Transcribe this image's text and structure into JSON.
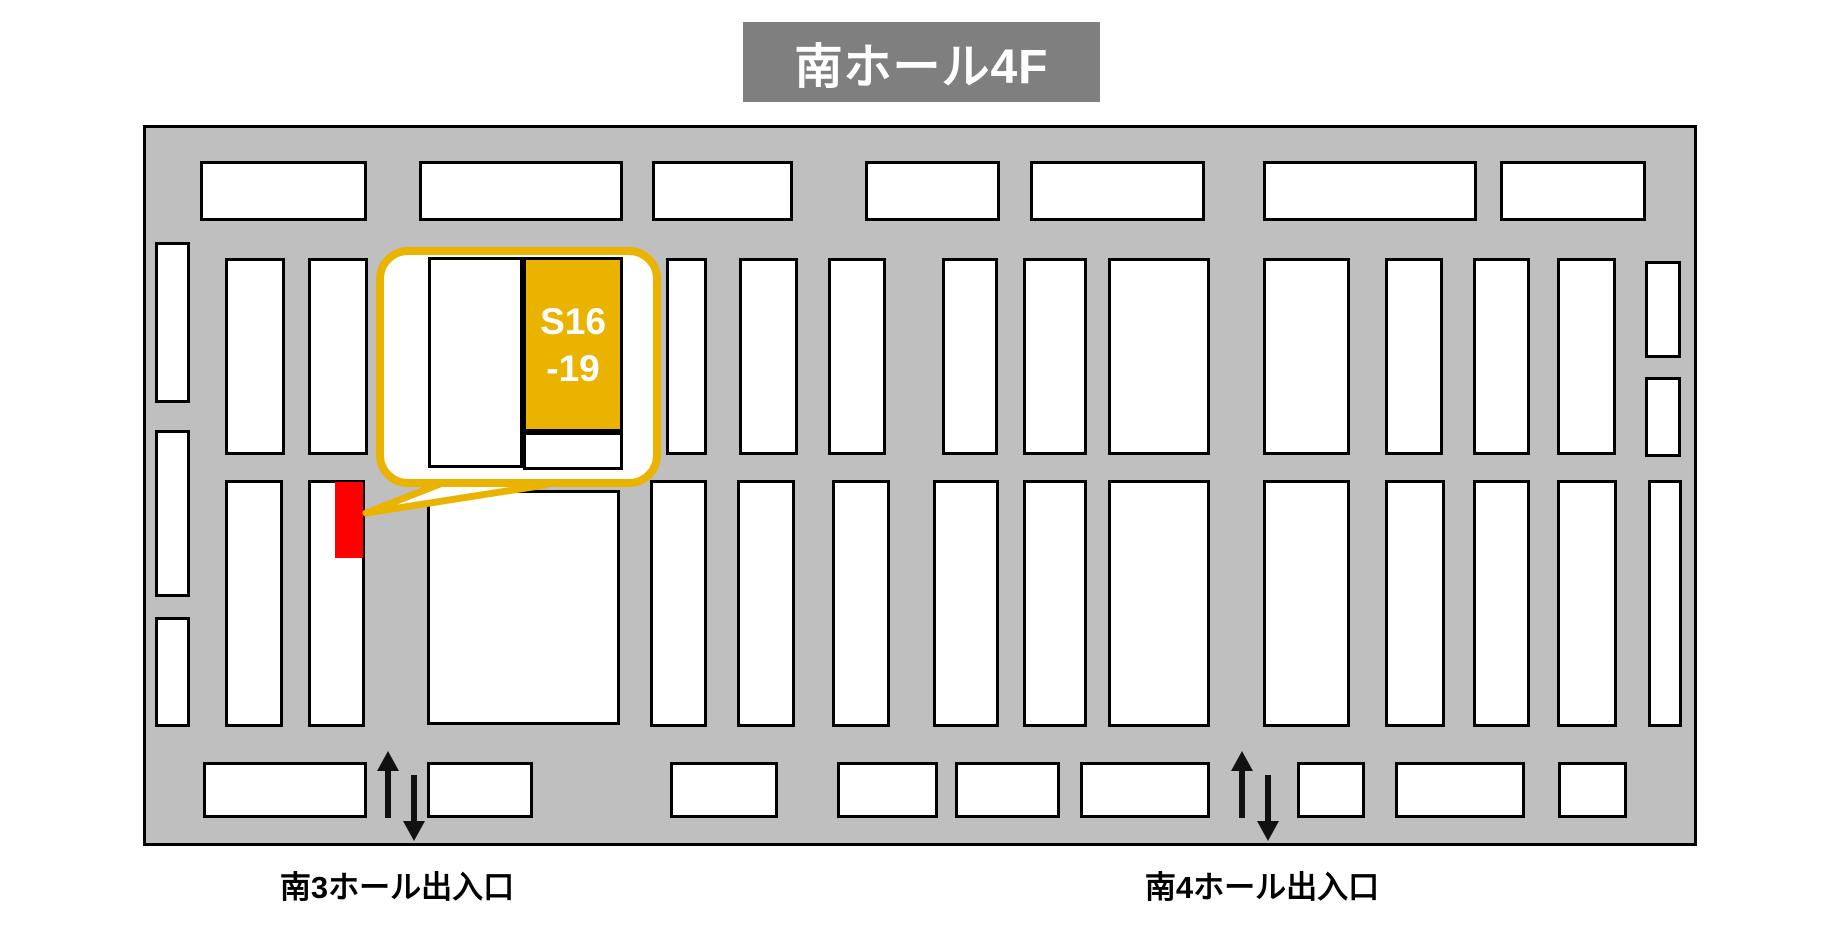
{
  "banner": {
    "title": "南ホール4F",
    "bg": "#7F7F7F",
    "text_color": "#FFFFFF"
  },
  "callout": {
    "label_line1": "S16",
    "label_line2": "-19",
    "border_color": "#E9B300",
    "highlight_fill": "#E9B300",
    "target_color": "#FF0000",
    "inner_white_booth": [
      428,
      257,
      95,
      211
    ],
    "inner_gold_booth": [
      523,
      257,
      100,
      175
    ],
    "inner_small_booth": [
      523,
      432,
      100,
      38
    ]
  },
  "entrances": [
    {
      "label": "南3ホール出入口",
      "icons": [
        "arrow-up-icon",
        "arrow-down-icon"
      ]
    },
    {
      "label": "南4ホール出入口",
      "icons": [
        "arrow-up-icon",
        "arrow-down-icon"
      ]
    }
  ],
  "map": {
    "bg": "#BFBFBF",
    "booth_fill": "#FFFFFF",
    "border_color": "#000000",
    "red_booth": [
      335,
      482,
      28,
      76
    ],
    "booths": [
      [
        200,
        161,
        167,
        60
      ],
      [
        419,
        161,
        204,
        60
      ],
      [
        652,
        161,
        141,
        60
      ],
      [
        865,
        161,
        135,
        60
      ],
      [
        1030,
        161,
        175,
        60
      ],
      [
        1263,
        161,
        214,
        60
      ],
      [
        1500,
        161,
        146,
        60
      ],
      [
        155,
        242,
        35,
        161
      ],
      [
        155,
        430,
        35,
        167
      ],
      [
        155,
        617,
        35,
        110
      ],
      [
        225,
        258,
        60,
        197
      ],
      [
        308,
        258,
        60,
        197
      ],
      [
        666,
        258,
        41,
        197
      ],
      [
        739,
        258,
        59,
        197
      ],
      [
        828,
        258,
        58,
        197
      ],
      [
        942,
        258,
        56,
        197
      ],
      [
        1023,
        258,
        64,
        197
      ],
      [
        1108,
        258,
        102,
        197
      ],
      [
        1263,
        258,
        87,
        197
      ],
      [
        1385,
        258,
        58,
        197
      ],
      [
        1473,
        258,
        57,
        197
      ],
      [
        1557,
        258,
        59,
        197
      ],
      [
        1645,
        261,
        36,
        97
      ],
      [
        1645,
        377,
        36,
        80
      ],
      [
        225,
        480,
        58,
        247
      ],
      [
        308,
        480,
        57,
        247
      ],
      [
        427,
        490,
        193,
        235
      ],
      [
        650,
        480,
        57,
        247
      ],
      [
        737,
        480,
        58,
        247
      ],
      [
        832,
        480,
        58,
        247
      ],
      [
        933,
        480,
        66,
        247
      ],
      [
        1023,
        480,
        64,
        247
      ],
      [
        1108,
        480,
        102,
        247
      ],
      [
        1263,
        480,
        87,
        247
      ],
      [
        1385,
        480,
        60,
        247
      ],
      [
        1473,
        480,
        57,
        247
      ],
      [
        1557,
        480,
        60,
        247
      ],
      [
        1648,
        480,
        34,
        247
      ],
      [
        203,
        762,
        164,
        56
      ],
      [
        427,
        762,
        106,
        56
      ],
      [
        670,
        762,
        108,
        56
      ],
      [
        837,
        762,
        101,
        56
      ],
      [
        955,
        762,
        105,
        56
      ],
      [
        1080,
        762,
        130,
        56
      ],
      [
        1297,
        762,
        68,
        56
      ],
      [
        1395,
        762,
        130,
        56
      ],
      [
        1558,
        762,
        69,
        56
      ]
    ]
  }
}
